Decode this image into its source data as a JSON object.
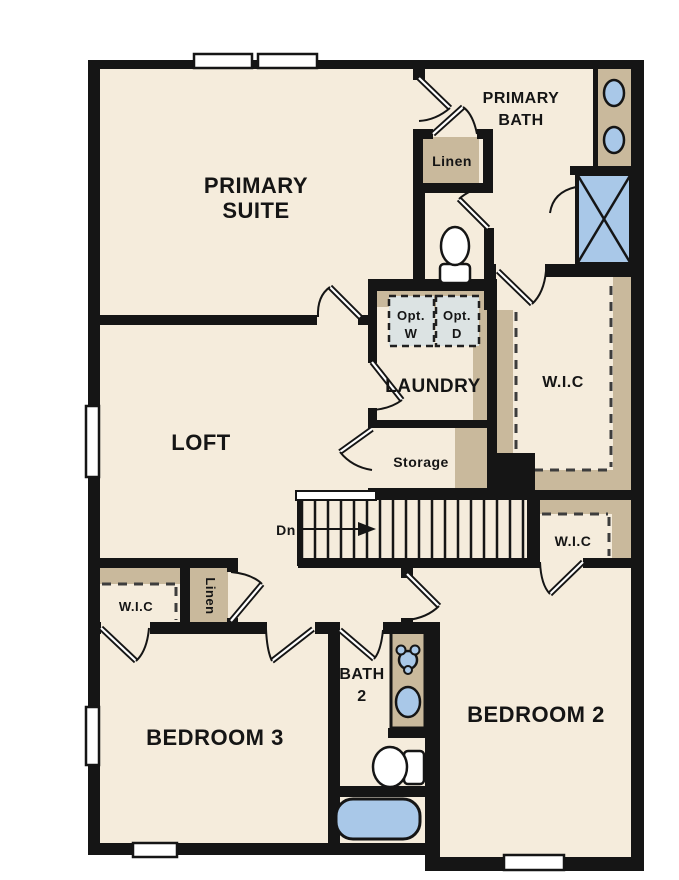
{
  "colors": {
    "wall": "#151515",
    "floor": "#f5ecdc",
    "tan": "#c9b99c",
    "fixture": "#a9c8e8",
    "appliance": "#dce3e3",
    "dash": "#3d3d3d",
    "page": "#ffffff"
  },
  "labels": {
    "primary_suite": [
      "PRIMARY",
      "SUITE"
    ],
    "primary_bath": [
      "PRIMARY",
      "BATH"
    ],
    "linen_upper": "Linen",
    "laundry": "LAUNDRY",
    "washer": [
      "Opt.",
      "W"
    ],
    "dryer": [
      "Opt.",
      "D"
    ],
    "wic_main": "W.I.C",
    "storage": "Storage",
    "stairs_down": "Dn",
    "wic_right": "W.I.C",
    "loft": "LOFT",
    "wic_bedroom3": "W.I.C",
    "linen_lower": "Linen",
    "bedroom3": "BEDROOM 3",
    "bath2": [
      "BATH",
      "2"
    ],
    "bedroom2": "BEDROOM 2"
  }
}
